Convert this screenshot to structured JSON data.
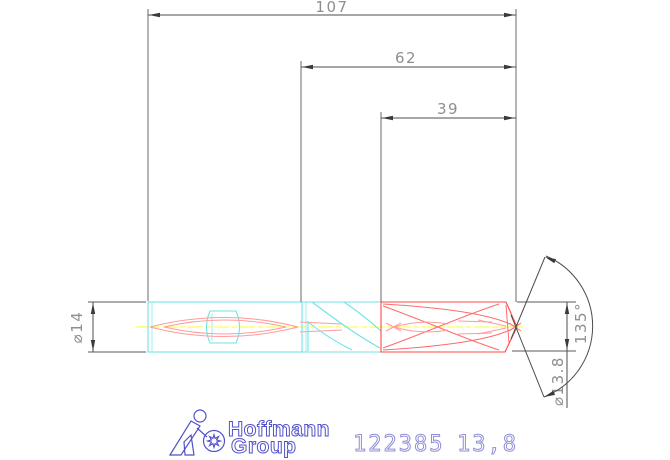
{
  "drawing": {
    "kind": "technical-dimension-drawing",
    "view": "side-view-drill"
  },
  "dimensions": {
    "length_overall": "107",
    "length_flute": "62",
    "length_head": "39",
    "shank_diameter": "⌀14",
    "cut_diameter": "⌀13.8",
    "point_angle": "135°"
  },
  "branding": {
    "name_top": "Hoffmann",
    "name_bottom": "Group"
  },
  "product": {
    "article_number": "122385",
    "size": "13,8"
  },
  "icons": {
    "logo": "hoffmann-group-figure-with-gear"
  },
  "colors": {
    "background": "#ffffff",
    "shank_outline_cyan": "#6fe3e3",
    "head_outline_red": "#ff4747",
    "coolant_line_light_red": "#ff9c9c",
    "centerline_yellow": "#ffff33",
    "dimension_line_gray": "#4d4d4d",
    "dimension_text_gray": "#8f8f8f",
    "brand_blue": "#5252c8",
    "stamp_blue": "#8f8fd8"
  }
}
